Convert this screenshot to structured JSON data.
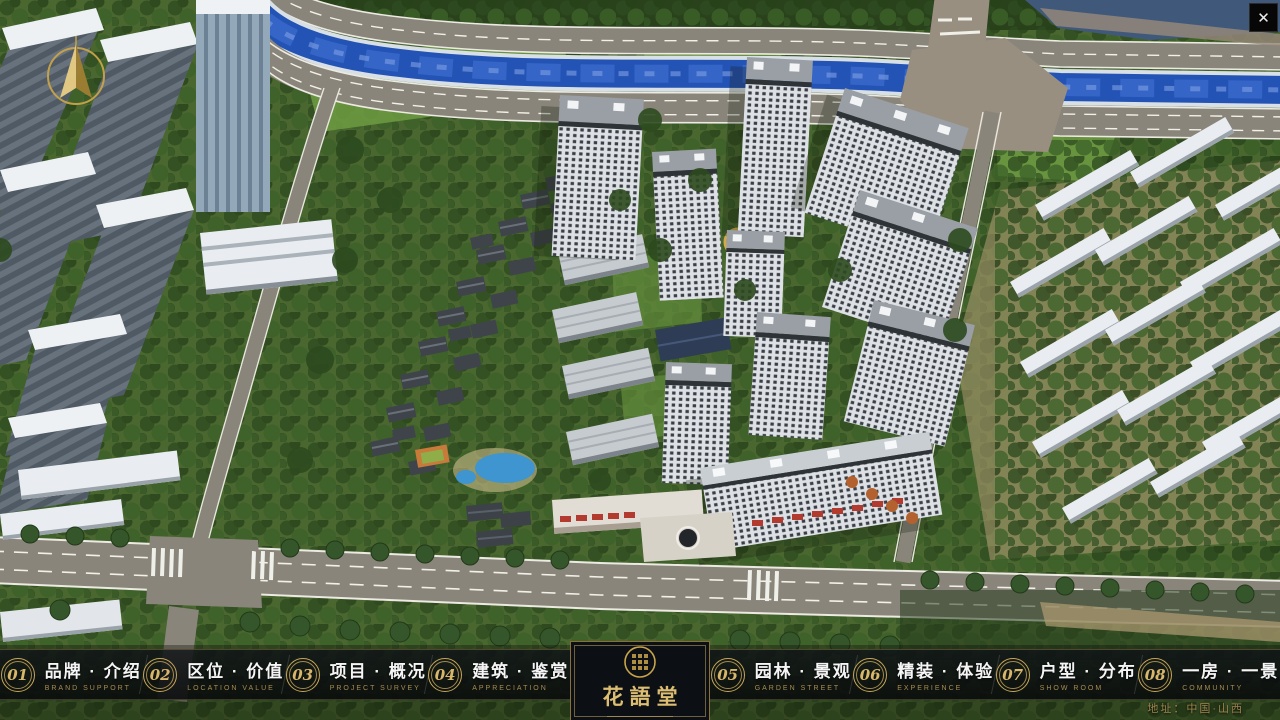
{
  "window": {
    "close_glyph": "✕"
  },
  "project": {
    "logo_name": "花語堂"
  },
  "nav": {
    "items": [
      {
        "num": "01",
        "label": "品牌 · 介绍",
        "sub": "BRAND SUPPORT"
      },
      {
        "num": "02",
        "label": "区位 · 价值",
        "sub": "LOCATION VALUE"
      },
      {
        "num": "03",
        "label": "项目 · 概况",
        "sub": "PROJECT SURVEY"
      },
      {
        "num": "04",
        "label": "建筑 · 鉴赏",
        "sub": "APPRECIATION"
      },
      {
        "num": "05",
        "label": "园林 · 景观",
        "sub": "GARDEN STREET"
      },
      {
        "num": "06",
        "label": "精装 · 体验",
        "sub": "EXPERIENCE"
      },
      {
        "num": "07",
        "label": "户型 · 分布",
        "sub": "SHOW ROOM"
      },
      {
        "num": "08",
        "label": "一房 · 一景",
        "sub": "COMMUNITY"
      }
    ]
  },
  "footer": {
    "address": "地址：中国·山西"
  },
  "colors": {
    "gold_accent": "#c9a44a",
    "nav_label": "#f5f5f5",
    "nav_sublabel": "#a98c4e",
    "river_blue": "#2353b5",
    "navbar_bg": "rgba(10,13,17,0.84)",
    "close_bg": "#070707"
  }
}
